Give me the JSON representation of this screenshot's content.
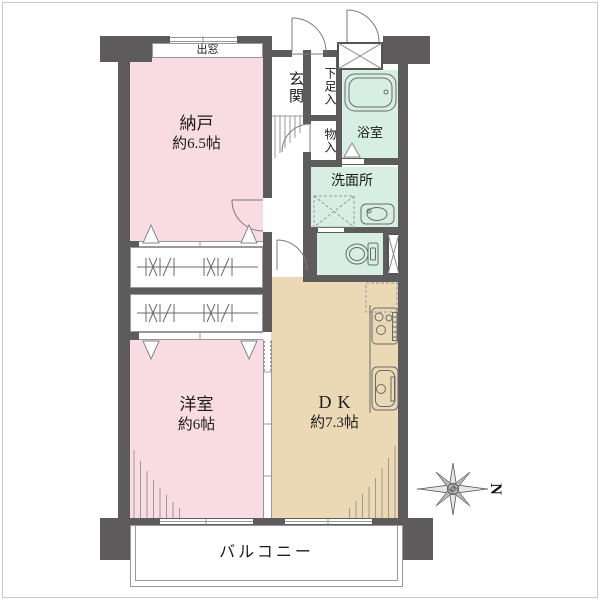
{
  "floorplan": {
    "compass": {
      "label": "N"
    },
    "rooms": {
      "nando": {
        "label": "納戸",
        "size": "約6.5帖",
        "fill": "#f8dbe3"
      },
      "western_room": {
        "label": "洋室",
        "size": "約6帖",
        "fill": "#f8dbe3"
      },
      "dk": {
        "label": "DK",
        "size": "約7.3帖",
        "fill": "#ebd9b6"
      },
      "entrance": {
        "label": "玄関"
      },
      "shoe_cabinet": {
        "label": "下足入"
      },
      "hall_closet": {
        "label": "物入"
      },
      "bathroom": {
        "label": "浴室",
        "fill": "#d6efe2"
      },
      "washroom": {
        "label": "洗面所",
        "fill": "#d6efe2"
      },
      "toilet": {
        "fill": "#d6efe2"
      },
      "balcony": {
        "label": "バルコニー"
      },
      "bay_window": {
        "label": "出窓"
      }
    },
    "colors": {
      "wall": "#5d5b5b",
      "pink_room": "#f8dbe3",
      "green_room": "#d6efe2",
      "tan_room": "#ebd9b6",
      "line": "#888888"
    }
  }
}
